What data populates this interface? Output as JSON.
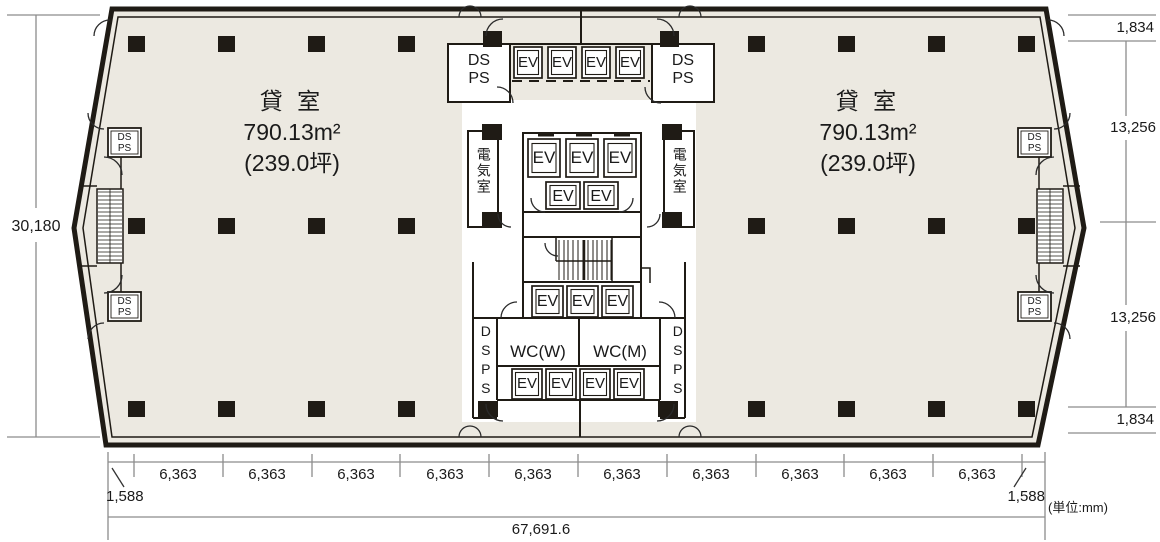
{
  "labels": {
    "ev": "EV",
    "ds_ps": "DS\nPS",
    "ds_ps_vertical": "DSPS",
    "electrical_room": "電気室",
    "wc_women": "WC(W)",
    "wc_men": "WC(M)"
  },
  "tenant_left": {
    "name": "貸 室",
    "area": "790.13m²",
    "tsubo": "(239.0坪)"
  },
  "tenant_right": {
    "name": "貸 室",
    "area": "790.13m²",
    "tsubo": "(239.0坪)"
  },
  "dimensions": {
    "overall_depth": "30,180",
    "right_top_offset": "1,834",
    "right_upper": "13,256",
    "right_lower": "13,256",
    "right_bottom_offset": "1,834",
    "bottom_left_offset": "1,588",
    "bottom_right_offset": "1,588",
    "bottom_spans": [
      "6,363",
      "6,363",
      "6,363",
      "6,363",
      "6,363",
      "6,363",
      "6,363",
      "6,363",
      "6,363",
      "6,363"
    ],
    "overall_width": "67,691.6",
    "unit_note": "(単位:mm)"
  },
  "colors": {
    "floor": "#ece9e1",
    "wall": "#1f1b15",
    "core": "#ffffff",
    "dim_line": "#8c8c8c",
    "text": "#1a1a1a"
  }
}
